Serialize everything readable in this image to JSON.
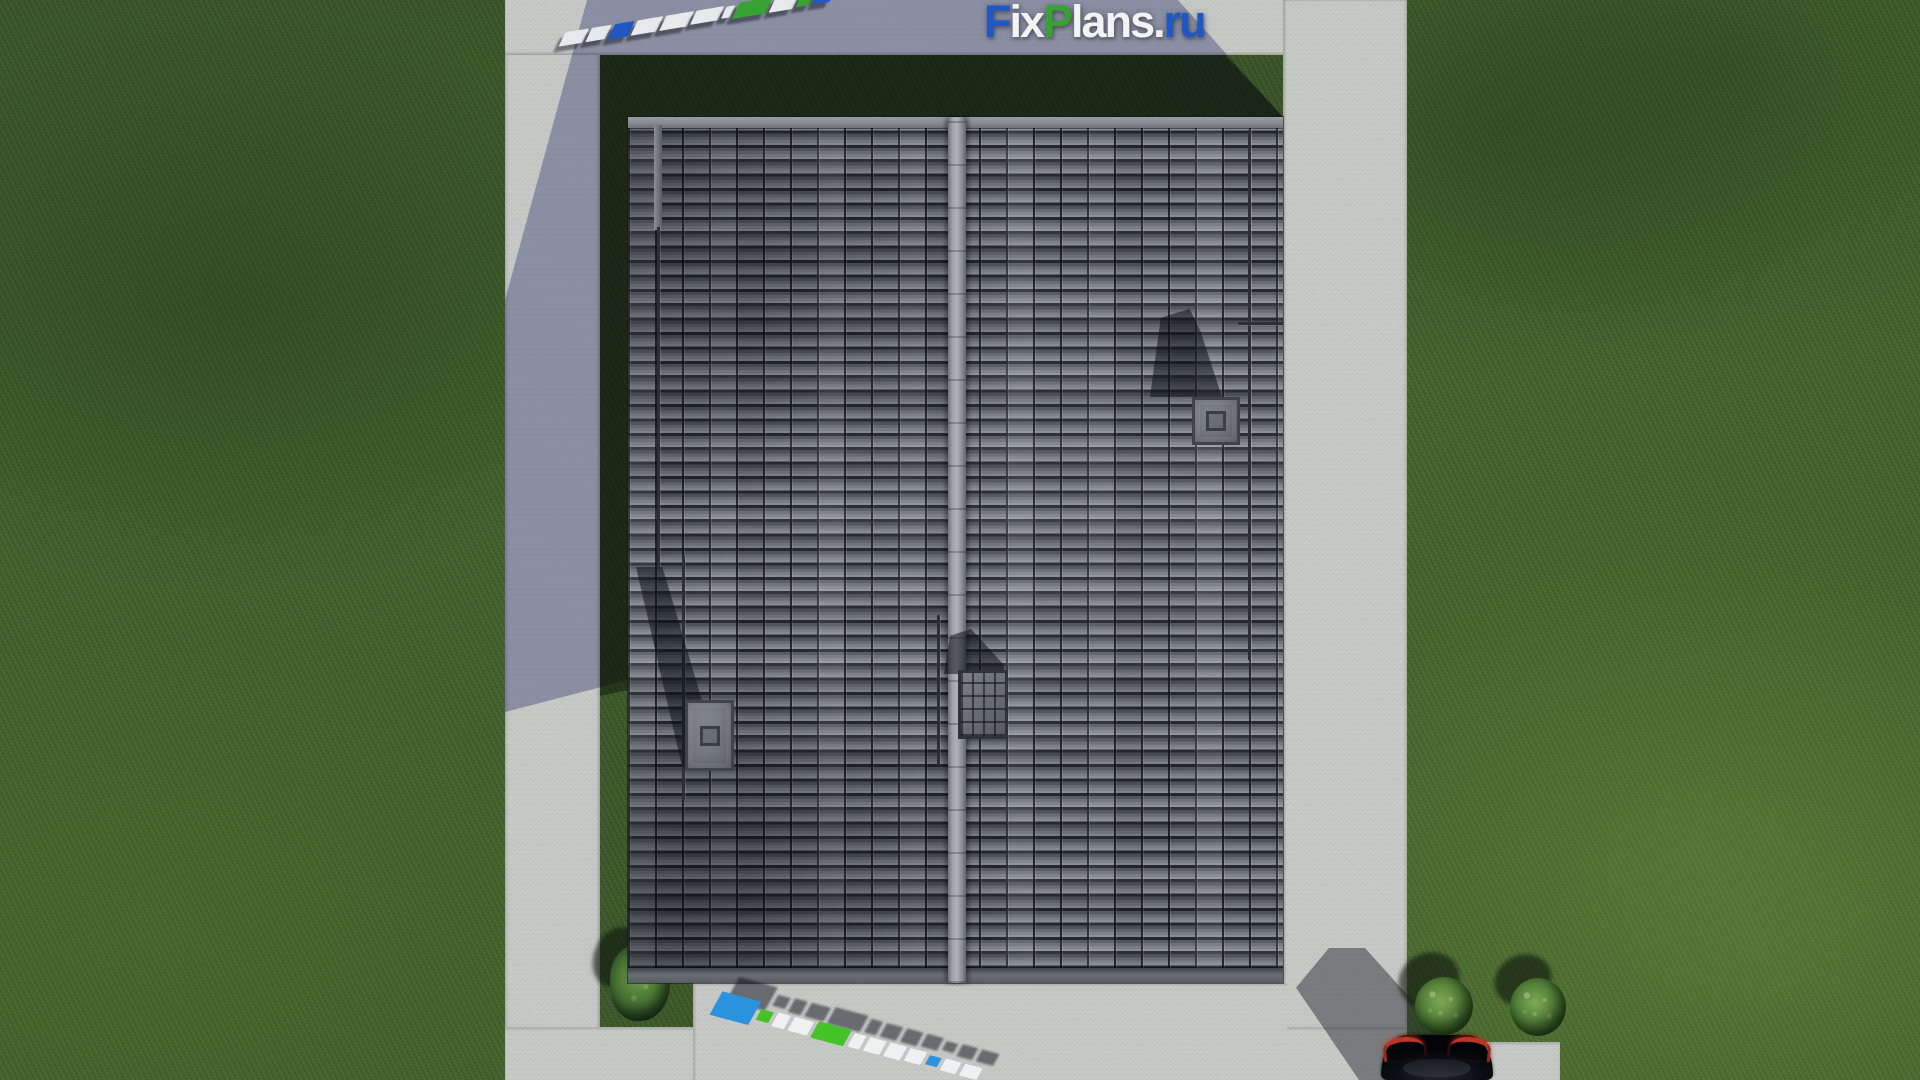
{
  "brand": {
    "logo_text": "FixPlans.ru",
    "segments": [
      {
        "text": "F",
        "color": "#2057c6"
      },
      {
        "text": "ix",
        "color": "#f2f3f4"
      },
      {
        "text": "P",
        "color": "#38a335"
      },
      {
        "text": "lans.",
        "color": "#f2f3f4"
      },
      {
        "text": "ru",
        "color": "#2057c6"
      }
    ]
  },
  "palette": {
    "brand_blue": "#2057c6",
    "brand_green": "#38a335",
    "grass": "#486831",
    "grass_shadow": "#20301b",
    "concrete": "#c8cac7",
    "concrete_shadow": "#8e93a4",
    "roof_tile": "#5c616a",
    "roof_ridge": "#9fa3aa",
    "car_body": "#0c0e13",
    "car_taillight": "#bc3527",
    "bush": "#4e7a35"
  },
  "scene": {
    "description": "Aerial top-down 3D render: gable tiled roof of a house framed by concrete walkways on a lawn, with two chimneys, a roof hatch, a parked black car and shrubs at bottom right, and FixPlans.ru watermarks."
  },
  "watermarks": {
    "represents": "FixPlans.ru",
    "top_blocks": [
      {
        "c": "#e8e9ec",
        "w": 24,
        "h": 13
      },
      {
        "c": "#e8e9ec",
        "w": 20,
        "h": 13
      },
      {
        "c": "#2057c6",
        "w": 20,
        "h": 14
      },
      {
        "c": "#e8e9ec",
        "w": 26,
        "h": 14
      },
      {
        "c": "#e8e9ec",
        "w": 28,
        "h": 14
      },
      {
        "c": "#e8e9ec",
        "w": 28,
        "h": 13
      },
      {
        "c": "#e8e9ec",
        "w": 9,
        "h": 11
      },
      {
        "c": "#38a335",
        "w": 34,
        "h": 15
      },
      {
        "c": "#e8e9ec",
        "w": 24,
        "h": 14
      },
      {
        "c": "#38a335",
        "w": 14,
        "h": 12
      },
      {
        "c": "#2057c6",
        "w": 18,
        "h": 13
      }
    ],
    "bottom_blocks": [
      {
        "c": "#2b93dd",
        "w": 40,
        "h": 26
      },
      {
        "c": "#46c229",
        "w": 13,
        "h": 12
      },
      {
        "c": "#eef0f2",
        "w": 13,
        "h": 15
      },
      {
        "c": "#eef0f2",
        "w": 20,
        "h": 15
      },
      {
        "c": "#46c229",
        "w": 34,
        "h": 18
      },
      {
        "c": "#eef0f2",
        "w": 12,
        "h": 15
      },
      {
        "c": "#eef0f2",
        "w": 17,
        "h": 15
      },
      {
        "c": "#eef0f2",
        "w": 17,
        "h": 15
      },
      {
        "c": "#eef0f2",
        "w": 17,
        "h": 14
      },
      {
        "c": "#2b93dd",
        "w": 12,
        "h": 10
      },
      {
        "c": "#eef0f2",
        "w": 16,
        "h": 13
      },
      {
        "c": "#eef0f2",
        "w": 18,
        "h": 13
      }
    ]
  }
}
